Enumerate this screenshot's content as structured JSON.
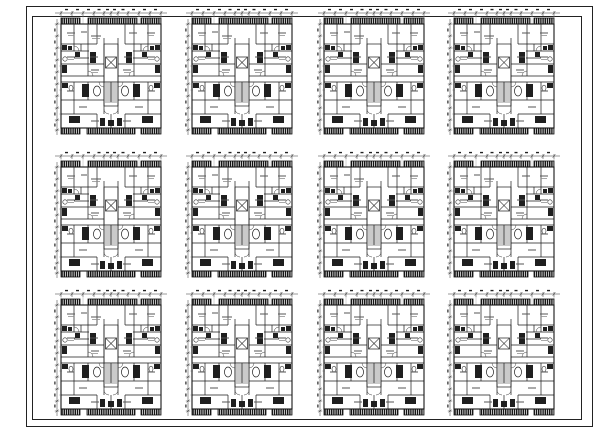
{
  "sheet": {
    "background_color": "#ffffff",
    "line_color": "#1b1b1b",
    "border_color": "#222222"
  },
  "grid": {
    "rows": 3,
    "cols": 4,
    "col_x": [
      54,
      185,
      317,
      447
    ],
    "row_y": [
      8,
      151,
      289
    ],
    "tile_width": 114,
    "tile_height": 130,
    "plan_count": 12
  },
  "plan": {
    "kind": "apartment-unit-floor-plan",
    "core": "stair-and-elevator-core",
    "balconies": "hatched-railing-bars-top-and-bottom",
    "dimension_lines": [
      "top",
      "left"
    ]
  }
}
